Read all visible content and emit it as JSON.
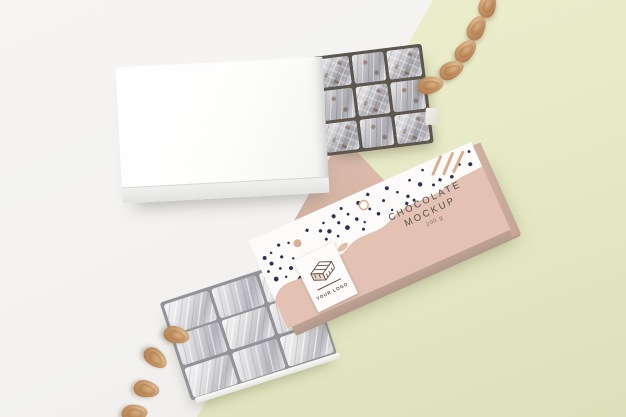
{
  "packaging": {
    "brand_line1": "CHOCOLATE",
    "brand_line2": "MOCKUP",
    "weight": "200 g",
    "label": {
      "logo_text": "YOUR LOGO",
      "icon": "chocolate-bar-illustration"
    }
  },
  "scene": {
    "objects": {
      "blank_bar": "white blank chocolate box with foil-wrapped bar",
      "wrapped_bar": "patterned chocolate wrapper with foil-wrapped bar",
      "almonds_top_right": 5,
      "almonds_bottom_left": 4
    }
  },
  "colors": {
    "background_left": "#f3f2f0",
    "background_right": "#e8eac7",
    "backdrop_sheet_pink": "#ddbcad",
    "wrapper_pink": "#e3c2b4",
    "wrapper_side_shade": "#b2988a",
    "pattern_white": "#fcfbf9",
    "pattern_navy": "#2e3252",
    "pattern_peach": "#dcae90",
    "foil_silver_light": "#e9e9ec",
    "foil_silver_dark": "#9b9ba2",
    "chocolate_brown": "#6f4c3e",
    "almond_tan": "#c89a6c",
    "box_white": "#fdfdfc",
    "text_dark": "#55504b"
  }
}
